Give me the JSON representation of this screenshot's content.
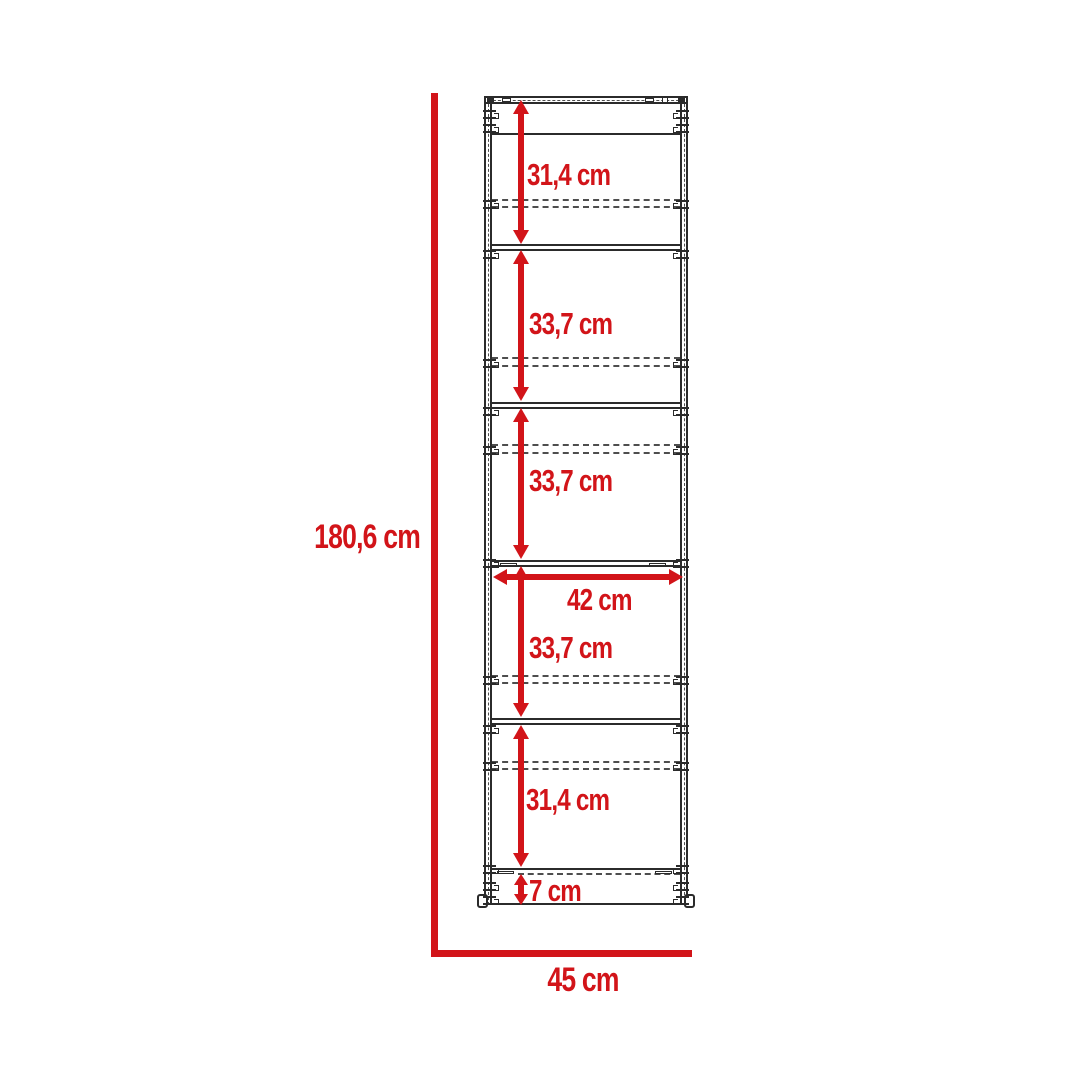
{
  "diagram": {
    "dimension_labels": {
      "overall_height": "180,6 cm",
      "overall_width": "45 cm",
      "shelf_width": "42 cm",
      "base_height": "7 cm",
      "sections": [
        "31,4 cm",
        "33,7 cm",
        "33,7 cm",
        "33,7 cm",
        "31,4 cm"
      ]
    },
    "colors": {
      "dimension_red": "#d21419",
      "line_dark": "#2b2b2b",
      "dashed_gray": "#4e4e4e",
      "background": "#ffffff"
    }
  }
}
